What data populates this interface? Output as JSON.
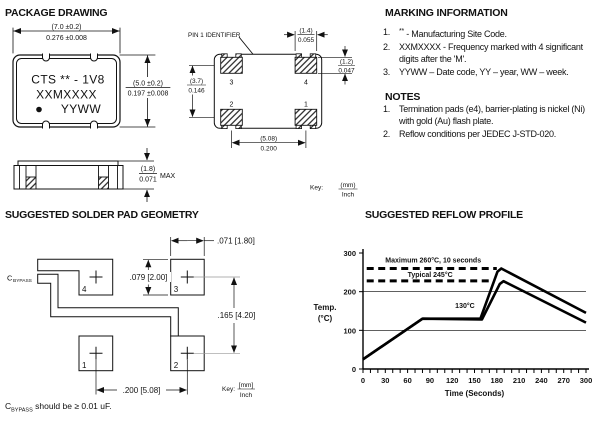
{
  "sections": {
    "package_drawing": {
      "title": "PACKAGE DRAWING"
    },
    "marking": {
      "title": "MARKING INFORMATION",
      "items": [
        {
          "num": "1.",
          "sup": "**",
          "rest": " - Manufacturing Site Code."
        },
        {
          "num": "2.",
          "sup": "",
          "rest": "XXMXXXX - Frequency marked with 4 significant digits after the 'M'."
        },
        {
          "num": "3.",
          "sup": "",
          "rest": "YYWW – Date code, YY – year, WW – week."
        }
      ]
    },
    "notes": {
      "title": "NOTES",
      "items": [
        {
          "num": "1.",
          "rest": "Termination pads (e4), barrier-plating is nickel (Ni) with gold (Au) flash plate."
        },
        {
          "num": "2.",
          "rest": "Reflow conditions per JEDEC J-STD-020."
        }
      ]
    },
    "solder_pad": {
      "title": "SUGGESTED SOLDER PAD GEOMETRY"
    },
    "reflow": {
      "title": "SUGGESTED REFLOW PROFILE"
    }
  },
  "front_view": {
    "line1": "CTS ** - 1V8",
    "line2": "XXMXXXX",
    "line3": "YYWW",
    "dim_top_mm": "(7.0 ±0.2)",
    "dim_top_in": "0.276 ±0.008",
    "dim_right_mm": "(5.0 ±0.2)",
    "dim_right_in": "0.197 ±0.008"
  },
  "side_view": {
    "dim_mm": "(1.8)",
    "dim_in": "0.071",
    "max_label": "MAX"
  },
  "land_pattern": {
    "pin1_label": "PIN 1 IDENTIFIER",
    "pad_labels": {
      "p1": "1",
      "p2": "2",
      "p3": "3",
      "p4": "4"
    },
    "dim_w_mm": "(1.4)",
    "dim_w_in": "0.055",
    "dim_h_mm": "(1.2)",
    "dim_h_in": "0.047",
    "dim_v_mm": "(3.7)",
    "dim_v_in": "0.146",
    "dim_p_mm": "(5.08)",
    "dim_p_in": "0.200",
    "key_label": "Key:",
    "key_mm": "(mm)",
    "key_in": "Inch"
  },
  "pad_geometry": {
    "cap_c": "C",
    "cap_sub": "BYPASS",
    "pad_labels": {
      "p1": "1",
      "p2": "2",
      "p3": "3",
      "p4": "4"
    },
    "dim_pad_w": ".071 [1.80]",
    "dim_pad_h": ".079 [2.00]",
    "dim_v": ".165 [4.20]",
    "dim_h": ".200 [5.08]",
    "key_label": "Key:",
    "key_mm": "[mm]",
    "key_in": "Inch",
    "note_c": "C",
    "note_sub": "BYPASS",
    "note_rest": " should be ≥ 0.01 uF."
  },
  "chart_data": {
    "type": "line",
    "title": "SUGGESTED REFLOW PROFILE",
    "xlabel": "Time (Seconds)",
    "ylabel_line1": "Temp.",
    "ylabel_line2": "(°C)",
    "xlim": [
      0,
      300
    ],
    "ylim": [
      0,
      300
    ],
    "xticks": [
      0,
      30,
      60,
      90,
      120,
      150,
      180,
      210,
      240,
      270,
      300
    ],
    "x_minor_step": 10,
    "yticks": [
      0,
      100,
      200,
      300
    ],
    "ygrid": [
      100,
      200
    ],
    "series": [
      {
        "name": "maximum-profile",
        "points": [
          [
            0,
            25
          ],
          [
            80,
            130
          ],
          [
            158,
            130
          ],
          [
            181,
            252
          ],
          [
            186,
            260
          ],
          [
            300,
            145
          ]
        ]
      },
      {
        "name": "typical-profile",
        "points": [
          [
            0,
            25
          ],
          [
            80,
            130
          ],
          [
            160,
            128
          ],
          [
            184,
            220
          ],
          [
            189,
            227
          ],
          [
            300,
            120
          ]
        ]
      }
    ],
    "ref_lines": [
      {
        "label": "Maximum  260°C,  10 seconds",
        "y": 260,
        "t0": 5,
        "t1": 180,
        "label_t": 30,
        "label_dy": -6
      },
      {
        "label": "Typical  245°C",
        "y": 228,
        "t0": 5,
        "t1": 172,
        "label_t": 60,
        "label_dy": -4
      }
    ],
    "annotations": [
      {
        "text": "130°C",
        "t": 124,
        "temp": 158
      }
    ]
  }
}
